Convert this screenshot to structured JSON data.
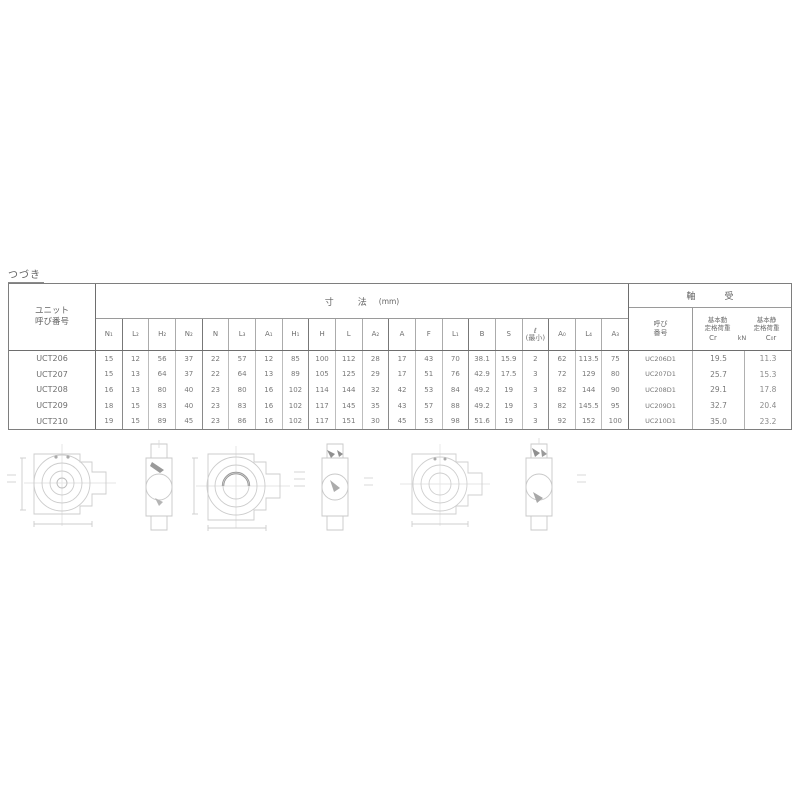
{
  "page": {
    "continuation_label": "つづき"
  },
  "table": {
    "unit_header": {
      "line1": "ユニット",
      "line2": "呼び番号"
    },
    "dims": {
      "title": "寸　　法",
      "unit": "(mm)",
      "columns": [
        "N₁",
        "L₂",
        "H₂",
        "N₂",
        "N",
        "L₃",
        "A₁",
        "H₁",
        "H",
        "L",
        "A₂",
        "A",
        "F",
        "L₁",
        "B",
        "S",
        "ℓ\n(最小)",
        "A₀",
        "L₄",
        "A₃"
      ]
    },
    "bearing": {
      "title": "軸　受",
      "number_header": {
        "line1": "呼び",
        "line2": "番号"
      },
      "dynamic_rating": {
        "line1": "基本動",
        "line2": "定格荷重",
        "symbol": "Cr"
      },
      "static_rating": {
        "line1": "基本静",
        "line2": "定格荷重",
        "symbol": "C₀r"
      },
      "load_unit": "kN"
    },
    "rows": [
      {
        "unit": "UCT206",
        "dims": [
          "15",
          "12",
          "56",
          "37",
          "22",
          "57",
          "12",
          "85",
          "100",
          "112",
          "28",
          "17",
          "43",
          "70",
          "38.1",
          "15.9",
          "2",
          "62",
          "113.5",
          "75"
        ],
        "bearing_no": "UC206D1",
        "cr": "19.5",
        "cor": "11.3"
      },
      {
        "unit": "UCT207",
        "dims": [
          "15",
          "13",
          "64",
          "37",
          "22",
          "64",
          "13",
          "89",
          "105",
          "125",
          "29",
          "17",
          "51",
          "76",
          "42.9",
          "17.5",
          "3",
          "72",
          "129",
          "80"
        ],
        "bearing_no": "UC207D1",
        "cr": "25.7",
        "cor": "15.3"
      },
      {
        "unit": "UCT208",
        "dims": [
          "16",
          "13",
          "80",
          "40",
          "23",
          "80",
          "16",
          "102",
          "114",
          "144",
          "32",
          "42",
          "53",
          "84",
          "49.2",
          "19",
          "3",
          "82",
          "144",
          "90"
        ],
        "bearing_no": "UC208D1",
        "cr": "29.1",
        "cor": "17.8"
      },
      {
        "unit": "UCT209",
        "dims": [
          "18",
          "15",
          "83",
          "40",
          "23",
          "83",
          "16",
          "102",
          "117",
          "145",
          "35",
          "43",
          "57",
          "88",
          "49.2",
          "19",
          "3",
          "82",
          "145.5",
          "95"
        ],
        "bearing_no": "UC209D1",
        "cr": "32.7",
        "cor": "20.4"
      },
      {
        "unit": "UCT210",
        "dims": [
          "19",
          "15",
          "89",
          "45",
          "23",
          "86",
          "16",
          "102",
          "117",
          "151",
          "30",
          "45",
          "53",
          "98",
          "51.6",
          "19",
          "3",
          "92",
          "152",
          "100"
        ],
        "bearing_no": "UC210D1",
        "cr": "35.0",
        "cor": "23.2"
      }
    ]
  },
  "drawings": {
    "figures": [
      "take-up-unit-front-view-1",
      "take-up-unit-side-view-1",
      "take-up-unit-front-view-2",
      "take-up-unit-side-view-2",
      "take-up-unit-front-view-3",
      "take-up-unit-side-view-3"
    ]
  }
}
